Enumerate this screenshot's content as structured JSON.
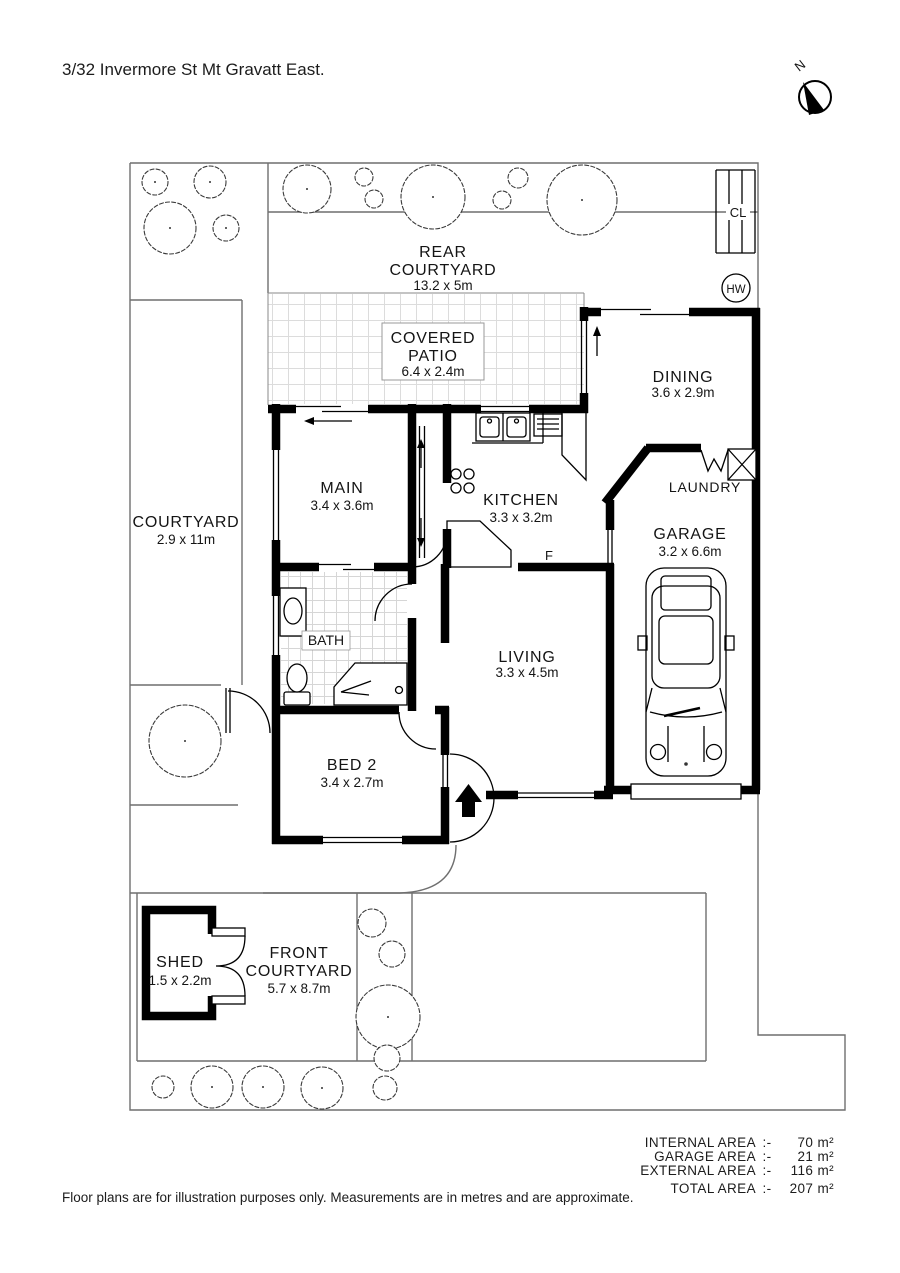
{
  "title": "3/32 Invermore St Mt Gravatt East.",
  "compass": {
    "north": "N"
  },
  "plan": {
    "rear_courtyard": {
      "line1": "REAR",
      "line2": "COURTYARD",
      "dims": "13.2 x 5m"
    },
    "covered_patio": {
      "line1": "COVERED",
      "line2": "PATIO",
      "dims": "6.4 x 2.4m"
    },
    "dining": {
      "name": "DINING",
      "dims": "3.6 x 2.9m"
    },
    "courtyard": {
      "name": "COURTYARD",
      "dims": "2.9 x 11m"
    },
    "main": {
      "name": "MAIN",
      "dims": "3.4 x 3.6m"
    },
    "kitchen": {
      "name": "KITCHEN",
      "dims": "3.3 x 3.2m"
    },
    "laundry": {
      "name": "LAUNDRY"
    },
    "garage": {
      "name": "GARAGE",
      "dims": "3.2 x 6.6m"
    },
    "bath": {
      "name": "BATH"
    },
    "living": {
      "name": "LIVING",
      "dims": "3.3 x 4.5m"
    },
    "bed2": {
      "name": "BED 2",
      "dims": "3.4 x 2.7m"
    },
    "shed": {
      "name": "SHED",
      "dims": "1.5 x 2.2m"
    },
    "front_courtyard": {
      "line1": "FRONT",
      "line2": "COURTYARD",
      "dims": "5.7 x 8.7m"
    },
    "fixtures": {
      "clothesline": "CL",
      "hot_water": "HW",
      "fridge": "F"
    }
  },
  "areas": {
    "rows": [
      {
        "label": "INTERNAL AREA",
        "sep": ":-",
        "value": "70 m²"
      },
      {
        "label": "GARAGE AREA",
        "sep": ":-",
        "value": "21 m²"
      },
      {
        "label": "EXTERNAL AREA",
        "sep": ":-",
        "value": "116 m²"
      },
      {
        "label": "TOTAL AREA",
        "sep": ":-",
        "value": "207 m²"
      }
    ]
  },
  "disclaimer": "Floor plans are for illustration purposes only. Measurements are in metres and are approximate.",
  "colors": {
    "wall": "#000000",
    "boundary": "#6f6f6f",
    "background": "#ffffff"
  }
}
